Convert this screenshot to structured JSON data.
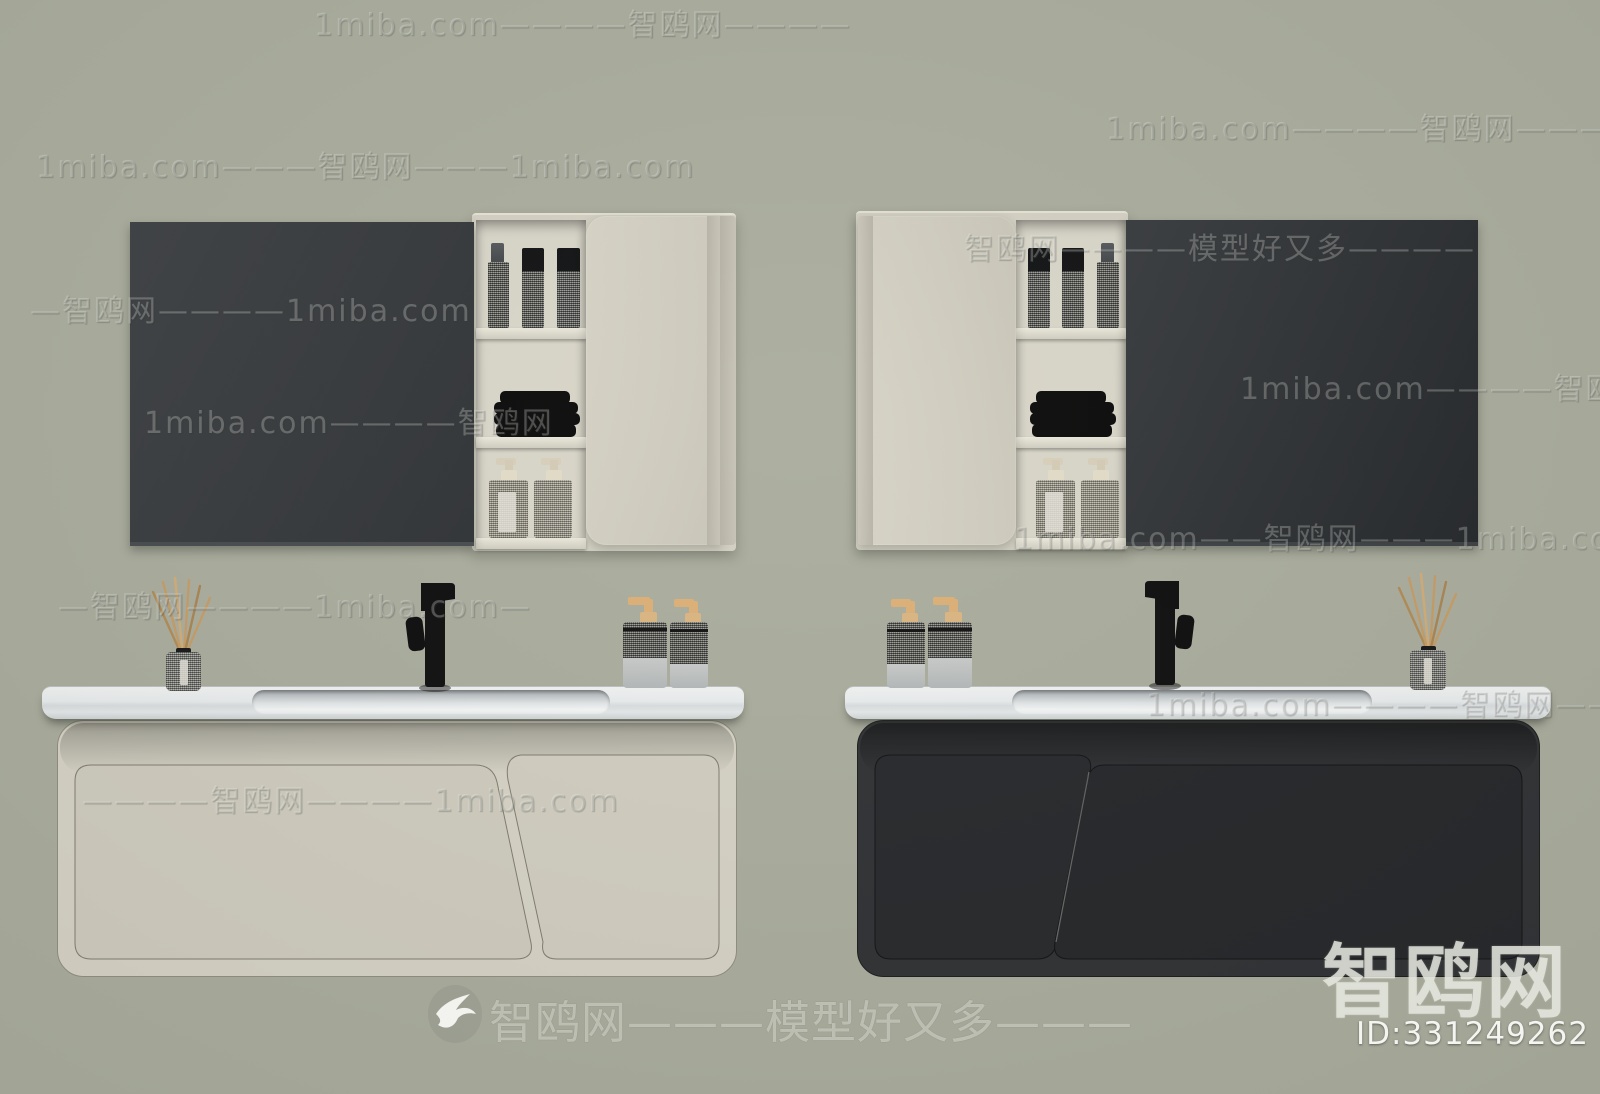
{
  "canvas": {
    "width": 1600,
    "height": 1094,
    "background_color": "#a9ac9c"
  },
  "colors": {
    "background": "#a9ac9c",
    "mirror_dark_left": "#333639",
    "mirror_dark_right": "#2a2d30",
    "cabinet_cream": "#d4d1c3",
    "cabinet_cream_panel": "#cecbbd",
    "cabinet_black": "#2b2d2f",
    "cabinet_black_panel": "#222427",
    "counter_white": "#eceeee",
    "faucet_black": "#0b0b0c",
    "towel_black": "#060606",
    "reed_stick_tan": "#c49c66",
    "pump_nozzle_tan": "#dcae74"
  },
  "watermark": {
    "site": "1miba.com",
    "brand": "智鸥网",
    "slogan": "模型好又多",
    "rows": [
      {
        "text": "1miba.com————智鸥网————"
      },
      {
        "text": "1miba.com————智鸥网————"
      },
      {
        "text": "1miba.com———智鸥网———1miba.com"
      },
      {
        "text": "智鸥网————模型好又多————"
      },
      {
        "text": "—智鸥网————1miba.com"
      },
      {
        "text": "1miba.com————智鸥网—"
      },
      {
        "text": "1miba.com————智鸥网"
      },
      {
        "text": "—智鸥网————1miba.com—"
      },
      {
        "text": "1miba.com————智鸥网———"
      },
      {
        "text": "————智鸥网————1miba.com"
      },
      {
        "text": "1miba.com——智鸥网———1miba.com"
      }
    ],
    "footer_line": "智鸥网———模型好又多———",
    "corner_brand": "智鸥网",
    "model_id": "ID:331249262"
  }
}
